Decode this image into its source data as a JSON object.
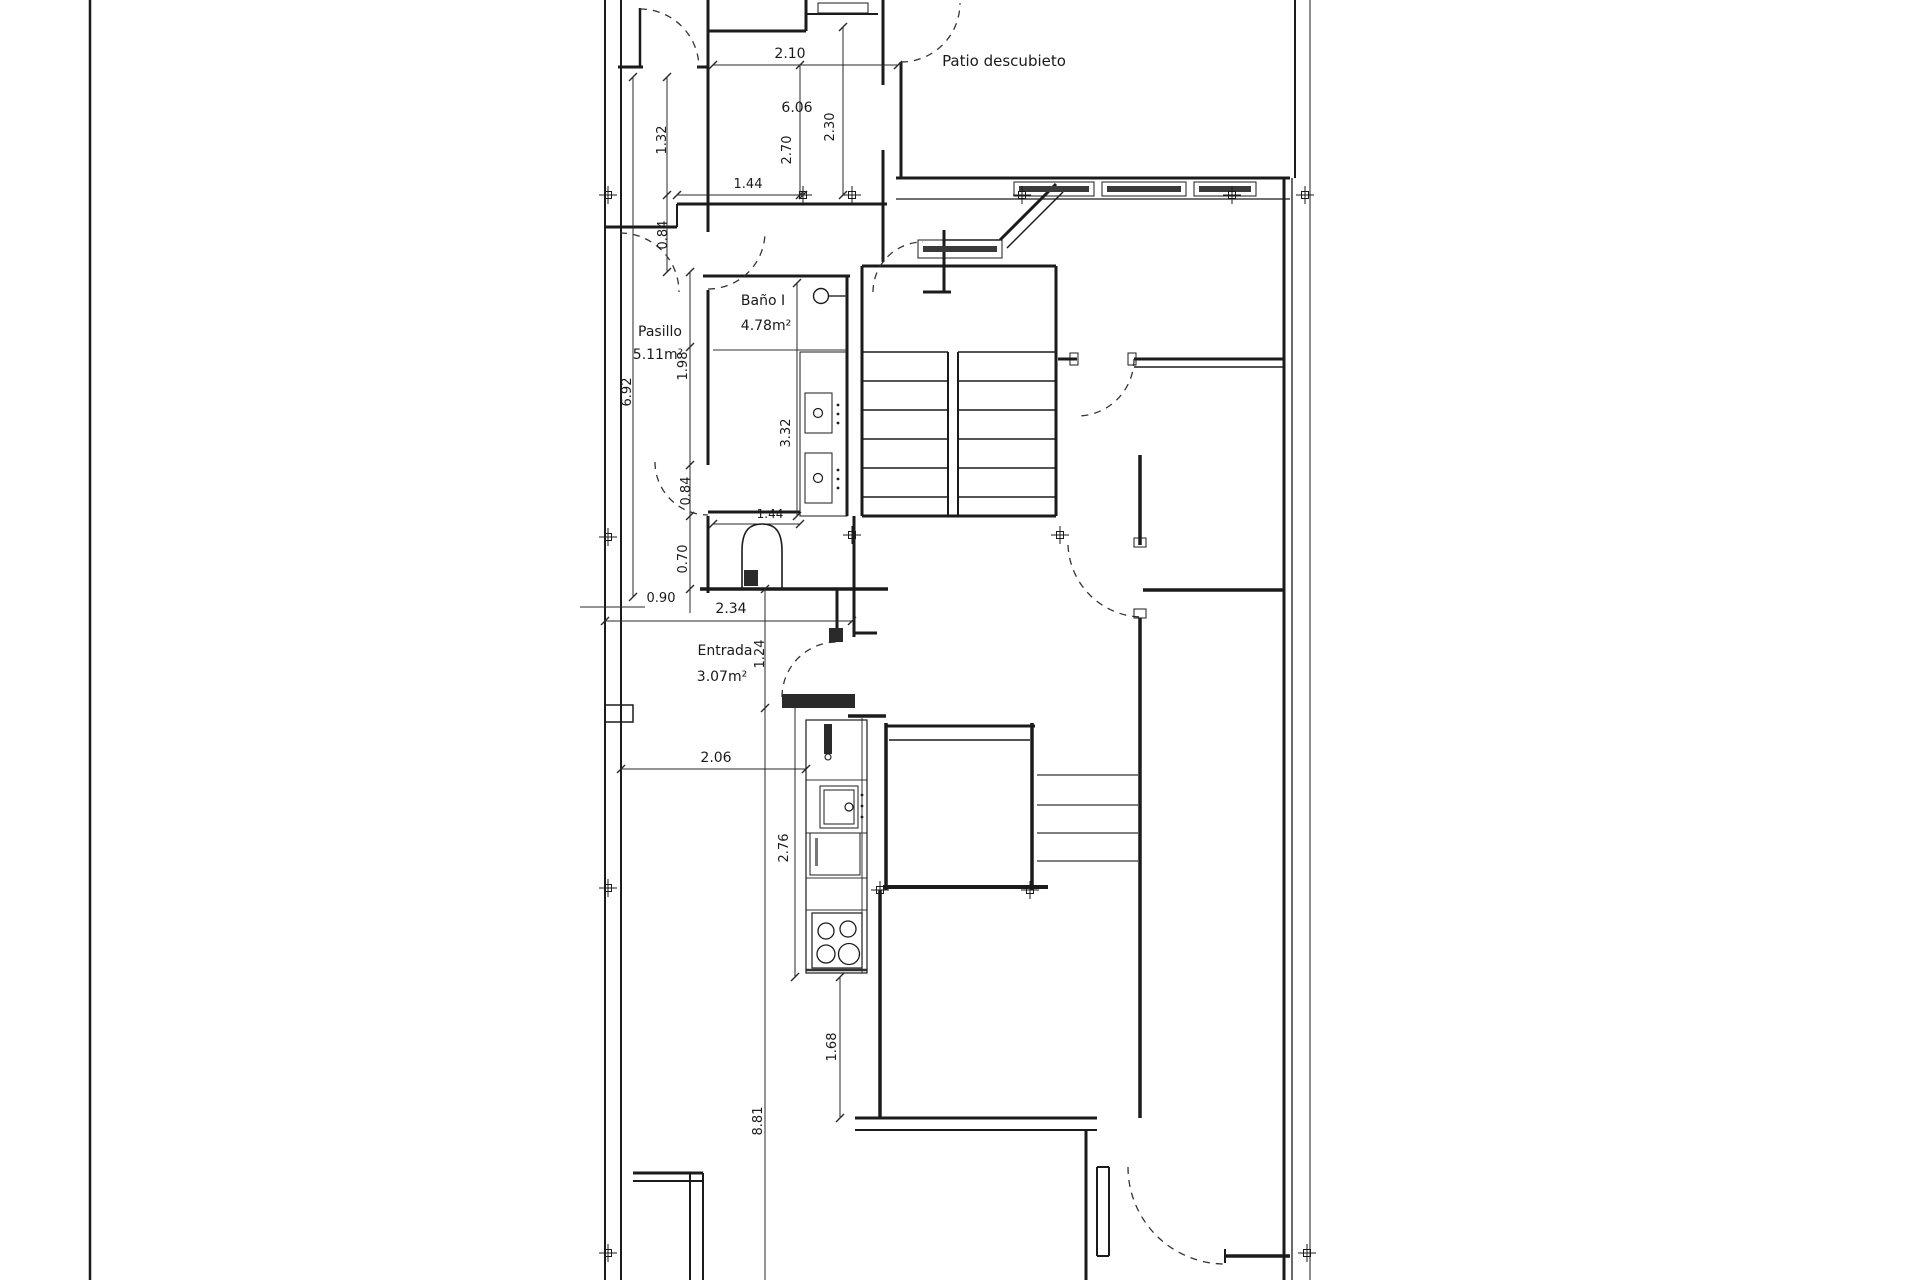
{
  "drawing_title": "Floor plan with Spanish room labels",
  "colors": {
    "background": "#ffffff",
    "ink": "#1b1b1b",
    "dim_line": "#2a2a2a",
    "dark_fill": "#2a2a2a",
    "window_bar": "#3a3a3a"
  },
  "room_labels": [
    {
      "id": "patio",
      "text": "Patio descubieto",
      "x": 1004,
      "y": 66,
      "size": 15,
      "rot": 0
    },
    {
      "id": "bano-name",
      "text": "Baño I",
      "x": 763,
      "y": 305,
      "size": 14,
      "rot": 0
    },
    {
      "id": "bano-area",
      "text": "4.78m²",
      "x": 766,
      "y": 330,
      "size": 14,
      "rot": 0
    },
    {
      "id": "pasillo-name",
      "text": "Pasillo",
      "x": 660,
      "y": 336,
      "size": 14,
      "rot": 0
    },
    {
      "id": "pasillo-area",
      "text": "5.11m²",
      "x": 658,
      "y": 359,
      "size": 14,
      "rot": 0
    },
    {
      "id": "entrada-name",
      "text": "Entrada",
      "x": 725,
      "y": 655,
      "size": 14,
      "rot": 0
    },
    {
      "id": "entrada-area",
      "text": "3.07m²",
      "x": 722,
      "y": 681,
      "size": 14,
      "rot": 0
    }
  ],
  "dim_labels": [
    {
      "id": "d210",
      "text": "2.10",
      "x": 790,
      "y": 58,
      "size": 14,
      "rot": 0
    },
    {
      "id": "d606",
      "text": "6.06",
      "x": 797,
      "y": 112,
      "size": 14,
      "rot": 0
    },
    {
      "id": "d144a",
      "text": "1.44",
      "x": 748,
      "y": 188,
      "size": 13,
      "rot": 0
    },
    {
      "id": "d270",
      "text": "2.70",
      "x": 791,
      "y": 150,
      "size": 13,
      "rot": 1
    },
    {
      "id": "d230",
      "text": "2.30",
      "x": 834,
      "y": 127,
      "size": 13,
      "rot": 1
    },
    {
      "id": "d132",
      "text": "1.32",
      "x": 666,
      "y": 140,
      "size": 13,
      "rot": 1
    },
    {
      "id": "d084a",
      "text": "0.84",
      "x": 667,
      "y": 235,
      "size": 13,
      "rot": 1
    },
    {
      "id": "d692",
      "text": "6.92",
      "x": 631,
      "y": 392,
      "size": 13,
      "rot": 1
    },
    {
      "id": "d198",
      "text": "1.98",
      "x": 687,
      "y": 366,
      "size": 13,
      "rot": 1
    },
    {
      "id": "d332",
      "text": "3.32",
      "x": 790,
      "y": 433,
      "size": 13,
      "rot": 1
    },
    {
      "id": "d084b",
      "text": "0.84",
      "x": 690,
      "y": 491,
      "size": 13,
      "rot": 1
    },
    {
      "id": "d070",
      "text": "0.70",
      "x": 687,
      "y": 559,
      "size": 13,
      "rot": 1
    },
    {
      "id": "d144b",
      "text": "1.44",
      "x": 770,
      "y": 518,
      "size": 12,
      "rot": 0
    },
    {
      "id": "d090",
      "text": "0.90",
      "x": 661,
      "y": 602,
      "size": 13,
      "rot": 0
    },
    {
      "id": "d234",
      "text": "2.34",
      "x": 731,
      "y": 613,
      "size": 14,
      "rot": 0
    },
    {
      "id": "d124",
      "text": "1.24",
      "x": 764,
      "y": 654,
      "size": 13,
      "rot": 1
    },
    {
      "id": "d206",
      "text": "2.06",
      "x": 716,
      "y": 762,
      "size": 14,
      "rot": 0
    },
    {
      "id": "d276",
      "text": "2.76",
      "x": 788,
      "y": 848,
      "size": 13,
      "rot": 1
    },
    {
      "id": "d168",
      "text": "1.68",
      "x": 836,
      "y": 1047,
      "size": 13,
      "rot": 1
    },
    {
      "id": "d881",
      "text": "8.81",
      "x": 762,
      "y": 1121,
      "size": 13,
      "rot": 1
    }
  ],
  "plan": {
    "frame_lines": [
      [
        90,
        0,
        90,
        1280,
        2.5
      ]
    ],
    "walls": [
      [
        605,
        0,
        605,
        1280,
        2
      ],
      [
        621,
        0,
        621,
        1280,
        2
      ],
      [
        618,
        67,
        643,
        67,
        3
      ],
      [
        640,
        8,
        640,
        67,
        2.5
      ],
      [
        697,
        67,
        708,
        67,
        3
      ],
      [
        708,
        0,
        708,
        232,
        3
      ],
      [
        708,
        290,
        708,
        465,
        3
      ],
      [
        708,
        516,
        708,
        593,
        3
      ],
      [
        708,
        31,
        806,
        31,
        3
      ],
      [
        806,
        0,
        806,
        31,
        3
      ],
      [
        806,
        14,
        878,
        14,
        2
      ],
      [
        883,
        0,
        883,
        262,
        3
      ],
      [
        901,
        62,
        901,
        178,
        3
      ],
      [
        896,
        178,
        1290,
        178,
        3
      ],
      [
        896,
        199,
        1290,
        199,
        1.3
      ],
      [
        1295,
        0,
        1295,
        178,
        2
      ],
      [
        1310,
        0,
        1310,
        1280,
        1
      ],
      [
        1284,
        178,
        1284,
        1280,
        3
      ],
      [
        1292,
        178,
        1292,
        1280,
        1.3
      ],
      [
        1000,
        240,
        1056,
        184,
        3
      ],
      [
        1007,
        248,
        1063,
        192,
        1.5
      ],
      [
        944,
        240,
        1000,
        240,
        1.5
      ],
      [
        944,
        230,
        944,
        293,
        3
      ],
      [
        923,
        292,
        951,
        292,
        3
      ],
      [
        677,
        204,
        887,
        204,
        3
      ],
      [
        677,
        204,
        677,
        227,
        2
      ],
      [
        605,
        227,
        677,
        227,
        3
      ],
      [
        1058,
        359,
        1077,
        359,
        3
      ],
      [
        1134,
        359,
        1284,
        359,
        3
      ],
      [
        1134,
        367,
        1284,
        367,
        1.5
      ],
      [
        862,
        266,
        1056,
        266,
        3
      ],
      [
        862,
        266,
        862,
        516,
        3
      ],
      [
        1056,
        266,
        1056,
        516,
        3
      ],
      [
        862,
        516,
        1056,
        516,
        3
      ],
      [
        948,
        352,
        948,
        516,
        2
      ],
      [
        958,
        352,
        958,
        516,
        2
      ],
      [
        854,
        516,
        854,
        637,
        3
      ],
      [
        854,
        633,
        877,
        633,
        3
      ],
      [
        703,
        276,
        850,
        276,
        3
      ],
      [
        847,
        276,
        847,
        516,
        3
      ],
      [
        708,
        512,
        800,
        512,
        3
      ],
      [
        700,
        589,
        888,
        589,
        3.5
      ],
      [
        837,
        589,
        837,
        640,
        3
      ],
      [
        848,
        716,
        886,
        716,
        3.5
      ],
      [
        886,
        726,
        1035,
        726,
        3
      ],
      [
        889,
        740,
        1030,
        740,
        1.5
      ],
      [
        886,
        723,
        886,
        890,
        3.5
      ],
      [
        1032,
        723,
        1032,
        890,
        3.5
      ],
      [
        883,
        887,
        1048,
        887,
        4
      ],
      [
        880,
        890,
        880,
        1118,
        3.5
      ],
      [
        1140,
        455,
        1140,
        545,
        3.5
      ],
      [
        1140,
        618,
        1140,
        1118,
        3.5
      ],
      [
        1143,
        590,
        1284,
        590,
        3.5
      ],
      [
        855,
        1118,
        1097,
        1118,
        3
      ],
      [
        855,
        1130,
        1097,
        1130,
        2
      ],
      [
        1086,
        1130,
        1086,
        1280,
        3
      ],
      [
        1097,
        1167,
        1097,
        1256,
        2
      ],
      [
        1109,
        1167,
        1109,
        1256,
        2
      ],
      [
        1097,
        1256,
        1109,
        1256,
        2
      ],
      [
        1097,
        1167,
        1109,
        1167,
        2
      ],
      [
        1225,
        1256,
        1290,
        1256,
        3.5
      ],
      [
        1225,
        1249,
        1225,
        1263,
        2
      ],
      [
        633,
        1173,
        703,
        1173,
        3
      ],
      [
        633,
        1181,
        703,
        1181,
        2
      ],
      [
        690,
        1173,
        690,
        1280,
        2
      ],
      [
        703,
        1173,
        703,
        1280,
        2
      ]
    ],
    "thin_lines": [
      [
        713,
        350,
        847,
        350,
        1
      ],
      [
        806,
        780,
        867,
        780,
        1
      ],
      [
        806,
        833,
        867,
        833,
        1
      ],
      [
        806,
        878,
        867,
        878,
        1
      ],
      [
        806,
        910,
        867,
        910,
        1
      ],
      [
        862,
        718,
        862,
        973,
        1
      ],
      [
        806,
        970,
        867,
        970,
        2.5
      ],
      [
        1037,
        775,
        1138,
        775,
        1.2
      ],
      [
        1037,
        805,
        1138,
        805,
        1.2
      ],
      [
        1037,
        833,
        1138,
        833,
        1.2
      ],
      [
        1037,
        861,
        1138,
        861,
        1.2
      ],
      [
        828,
        296,
        847,
        296,
        1.5
      ],
      [
        785,
        701,
        852,
        701,
        1
      ]
    ],
    "dim_lines": [
      [
        713,
        65,
        898,
        65
      ],
      [
        800,
        65,
        800,
        195
      ],
      [
        843,
        27,
        843,
        195
      ],
      [
        677,
        195,
        803,
        195
      ],
      [
        667,
        77,
        667,
        272
      ],
      [
        633,
        77,
        633,
        597
      ],
      [
        690,
        272,
        690,
        613
      ],
      [
        797,
        283,
        797,
        516
      ],
      [
        713,
        524,
        800,
        524
      ],
      [
        580,
        607,
        645,
        607
      ],
      [
        605,
        621,
        852,
        621
      ],
      [
        765,
        589,
        765,
        708
      ],
      [
        765,
        708,
        765,
        1280
      ],
      [
        621,
        769,
        806,
        769
      ],
      [
        795,
        702,
        795,
        977
      ],
      [
        840,
        977,
        840,
        1118
      ]
    ],
    "ticks": [
      [
        713,
        65
      ],
      [
        898,
        65
      ],
      [
        800,
        65
      ],
      [
        800,
        195
      ],
      [
        843,
        27
      ],
      [
        843,
        195
      ],
      [
        677,
        195
      ],
      [
        803,
        195
      ],
      [
        667,
        77
      ],
      [
        667,
        195
      ],
      [
        667,
        272
      ],
      [
        633,
        77
      ],
      [
        633,
        597
      ],
      [
        690,
        272
      ],
      [
        690,
        347
      ],
      [
        690,
        465
      ],
      [
        690,
        516
      ],
      [
        690,
        589
      ],
      [
        797,
        283
      ],
      [
        797,
        516
      ],
      [
        713,
        524
      ],
      [
        800,
        524
      ],
      [
        605,
        621
      ],
      [
        852,
        621
      ],
      [
        765,
        589
      ],
      [
        765,
        708
      ],
      [
        621,
        769
      ],
      [
        806,
        769
      ],
      [
        795,
        702
      ],
      [
        795,
        977
      ],
      [
        840,
        977
      ],
      [
        840,
        1118
      ]
    ],
    "door_arcs": [
      "M640,9 A59,59 0 0 1 699,68",
      "M901,62 A59,59 0 0 0 960,3",
      "M708,289 A57,57 0 0 0 765,232",
      "M620,233 A59,59 0 0 1 679,292",
      "M655,462 A53,53 0 0 0 708,515",
      "M873,292 A50,50 0 0 1 923,242",
      "M1134,359 A57,57 0 0 1 1077,416",
      "M1068,545 A75,75 0 0 0 1140,617",
      "M782,697 A55,55 0 0 1 837,642",
      "M1128,1167 A97,97 0 0 0 1225,1264"
    ],
    "stair_treads": {
      "ys": [
        352,
        381,
        410,
        439,
        468,
        497
      ],
      "spans": [
        [
          862,
          948
        ],
        [
          958,
          1056
        ]
      ],
      "w": 1.4
    },
    "rects": [
      {
        "x": 818,
        "y": 3,
        "w": 50,
        "h": 10,
        "sw": 1
      },
      {
        "x": 877,
        "y": 85,
        "w": 12,
        "h": 65,
        "sw": 1,
        "fill": "#ffffff"
      },
      {
        "x": 918,
        "y": 240,
        "w": 84,
        "h": 18,
        "sw": 1
      },
      {
        "x": 923,
        "y": 246,
        "w": 74,
        "h": 6,
        "fill": "#3a3a3a"
      },
      {
        "x": 1014,
        "y": 182,
        "w": 80,
        "h": 14,
        "sw": 1
      },
      {
        "x": 1019,
        "y": 186,
        "w": 70,
        "h": 6,
        "fill": "#3a3a3a"
      },
      {
        "x": 1102,
        "y": 182,
        "w": 84,
        "h": 14,
        "sw": 1
      },
      {
        "x": 1107,
        "y": 186,
        "w": 74,
        "h": 6,
        "fill": "#3a3a3a"
      },
      {
        "x": 1194,
        "y": 182,
        "w": 62,
        "h": 14,
        "sw": 1
      },
      {
        "x": 1199,
        "y": 186,
        "w": 52,
        "h": 6,
        "fill": "#3a3a3a"
      },
      {
        "x": 605,
        "y": 705,
        "w": 28,
        "h": 17,
        "sw": 1.5
      },
      {
        "x": 782,
        "y": 694,
        "w": 73,
        "h": 14,
        "fill": "#2a2a2a"
      },
      {
        "x": 829,
        "y": 628,
        "w": 14,
        "h": 14,
        "fill": "#2a2a2a"
      },
      {
        "x": 1070,
        "y": 353,
        "w": 8,
        "h": 12,
        "sw": 1
      },
      {
        "x": 1128,
        "y": 353,
        "w": 8,
        "h": 12,
        "sw": 1
      },
      {
        "x": 1134,
        "y": 538,
        "w": 12,
        "h": 9,
        "sw": 1
      },
      {
        "x": 1134,
        "y": 609,
        "w": 12,
        "h": 9,
        "sw": 1
      },
      {
        "x": 806,
        "y": 720,
        "w": 61,
        "h": 253,
        "sw": 1.2
      },
      {
        "x": 820,
        "y": 786,
        "w": 38,
        "h": 42,
        "sw": 1
      },
      {
        "x": 824,
        "y": 790,
        "w": 30,
        "h": 34,
        "sw": 1
      },
      {
        "x": 810,
        "y": 833,
        "w": 50,
        "h": 42,
        "sw": 1
      },
      {
        "x": 815,
        "y": 838,
        "w": 3,
        "h": 28,
        "fill": "#777777"
      },
      {
        "x": 812,
        "y": 913,
        "w": 50,
        "h": 55,
        "sw": 1.2
      },
      {
        "x": 800,
        "y": 352,
        "w": 47,
        "h": 164,
        "sw": 1
      },
      {
        "x": 805,
        "y": 393,
        "w": 27,
        "h": 40,
        "sw": 1
      },
      {
        "x": 805,
        "y": 453,
        "w": 27,
        "h": 50,
        "sw": 1
      },
      {
        "x": 824,
        "y": 724,
        "w": 8,
        "h": 30,
        "fill": "#2a2a2a"
      },
      {
        "x": 744,
        "y": 570,
        "w": 14,
        "h": 16,
        "fill": "#2a2a2a"
      }
    ],
    "circles": [
      {
        "cx": 826,
        "cy": 931,
        "r": 8,
        "sw": 1.3
      },
      {
        "cx": 848,
        "cy": 929,
        "r": 8,
        "sw": 1.3
      },
      {
        "cx": 826,
        "cy": 954,
        "r": 9,
        "sw": 1.3
      },
      {
        "cx": 849,
        "cy": 954,
        "r": 10.5,
        "sw": 1.3
      },
      {
        "cx": 849,
        "cy": 807,
        "r": 4,
        "sw": 1.2
      },
      {
        "cx": 818,
        "cy": 413,
        "r": 4.5,
        "sw": 1.2
      },
      {
        "cx": 818,
        "cy": 478,
        "r": 4.5,
        "sw": 1.2
      },
      {
        "cx": 821,
        "cy": 296,
        "r": 7.5,
        "sw": 1.4
      },
      {
        "cx": 828,
        "cy": 757,
        "r": 3,
        "sw": 1.1
      },
      {
        "cx": 862,
        "cy": 795,
        "r": 1.4,
        "fill": true
      },
      {
        "cx": 862,
        "cy": 806,
        "r": 1.4,
        "fill": true
      },
      {
        "cx": 862,
        "cy": 817,
        "r": 1.4,
        "fill": true
      },
      {
        "cx": 838,
        "cy": 405,
        "r": 1.4,
        "fill": true
      },
      {
        "cx": 838,
        "cy": 414,
        "r": 1.4,
        "fill": true
      },
      {
        "cx": 838,
        "cy": 423,
        "r": 1.4,
        "fill": true
      },
      {
        "cx": 838,
        "cy": 470,
        "r": 1.4,
        "fill": true
      },
      {
        "cx": 838,
        "cy": 479,
        "r": 1.4,
        "fill": true
      },
      {
        "cx": 838,
        "cy": 488,
        "r": 1.4,
        "fill": true
      }
    ],
    "toilet_path": "M742,588 L742,551 C742,530 750,524 762,524 C774,524 782,530 782,551 L782,588",
    "axis_markers": [
      [
        608,
        195
      ],
      [
        803,
        195
      ],
      [
        852,
        195
      ],
      [
        1022,
        195
      ],
      [
        1232,
        195
      ],
      [
        1305,
        195
      ],
      [
        608,
        537
      ],
      [
        852,
        535
      ],
      [
        1060,
        535
      ],
      [
        608,
        888
      ],
      [
        880,
        890
      ],
      [
        1030,
        890
      ],
      [
        608,
        1253
      ],
      [
        1307,
        1253
      ]
    ]
  }
}
